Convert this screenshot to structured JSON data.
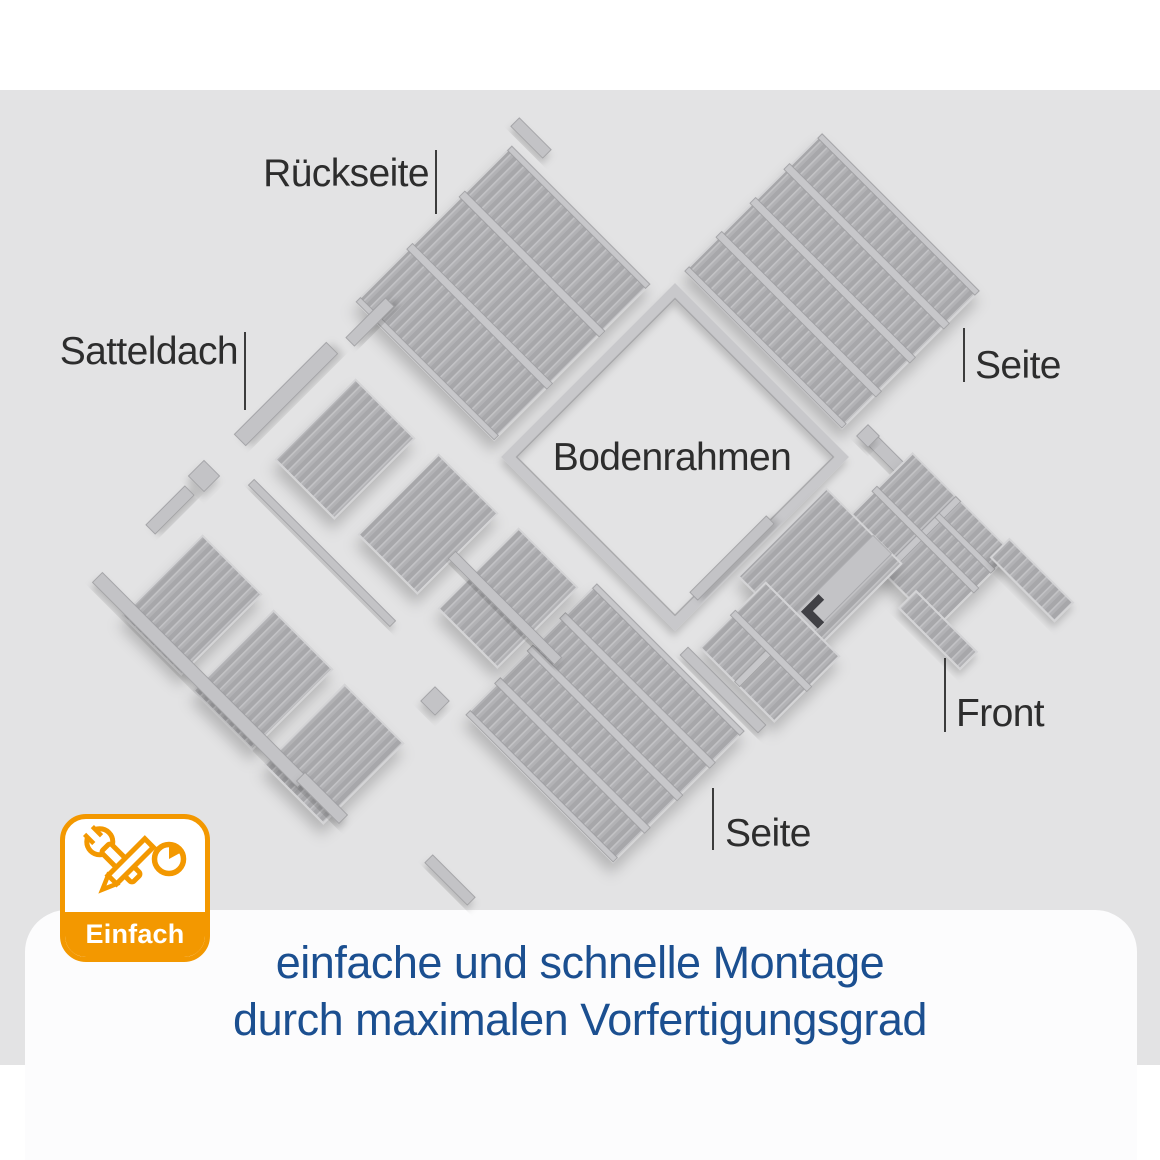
{
  "diagram": {
    "background": "#e3e3e4",
    "parts_color": "#b2b2b5",
    "labels": {
      "rueckseite": "Rückseite",
      "satteldach": "Satteldach",
      "seite_right": "Seite",
      "bodenrahmen": "Bodenrahmen",
      "front": "Front",
      "seite_bottom": "Seite"
    }
  },
  "badge": {
    "label": "Einfach",
    "color": "#F39800",
    "icons": [
      "wrench-icon",
      "pencil-icon",
      "clock-pie-icon"
    ]
  },
  "caption": {
    "line1": "einfache und schnelle Montage",
    "line2": "durch maximalen Vorfertigungsgrad",
    "color": "#1B4F90"
  }
}
